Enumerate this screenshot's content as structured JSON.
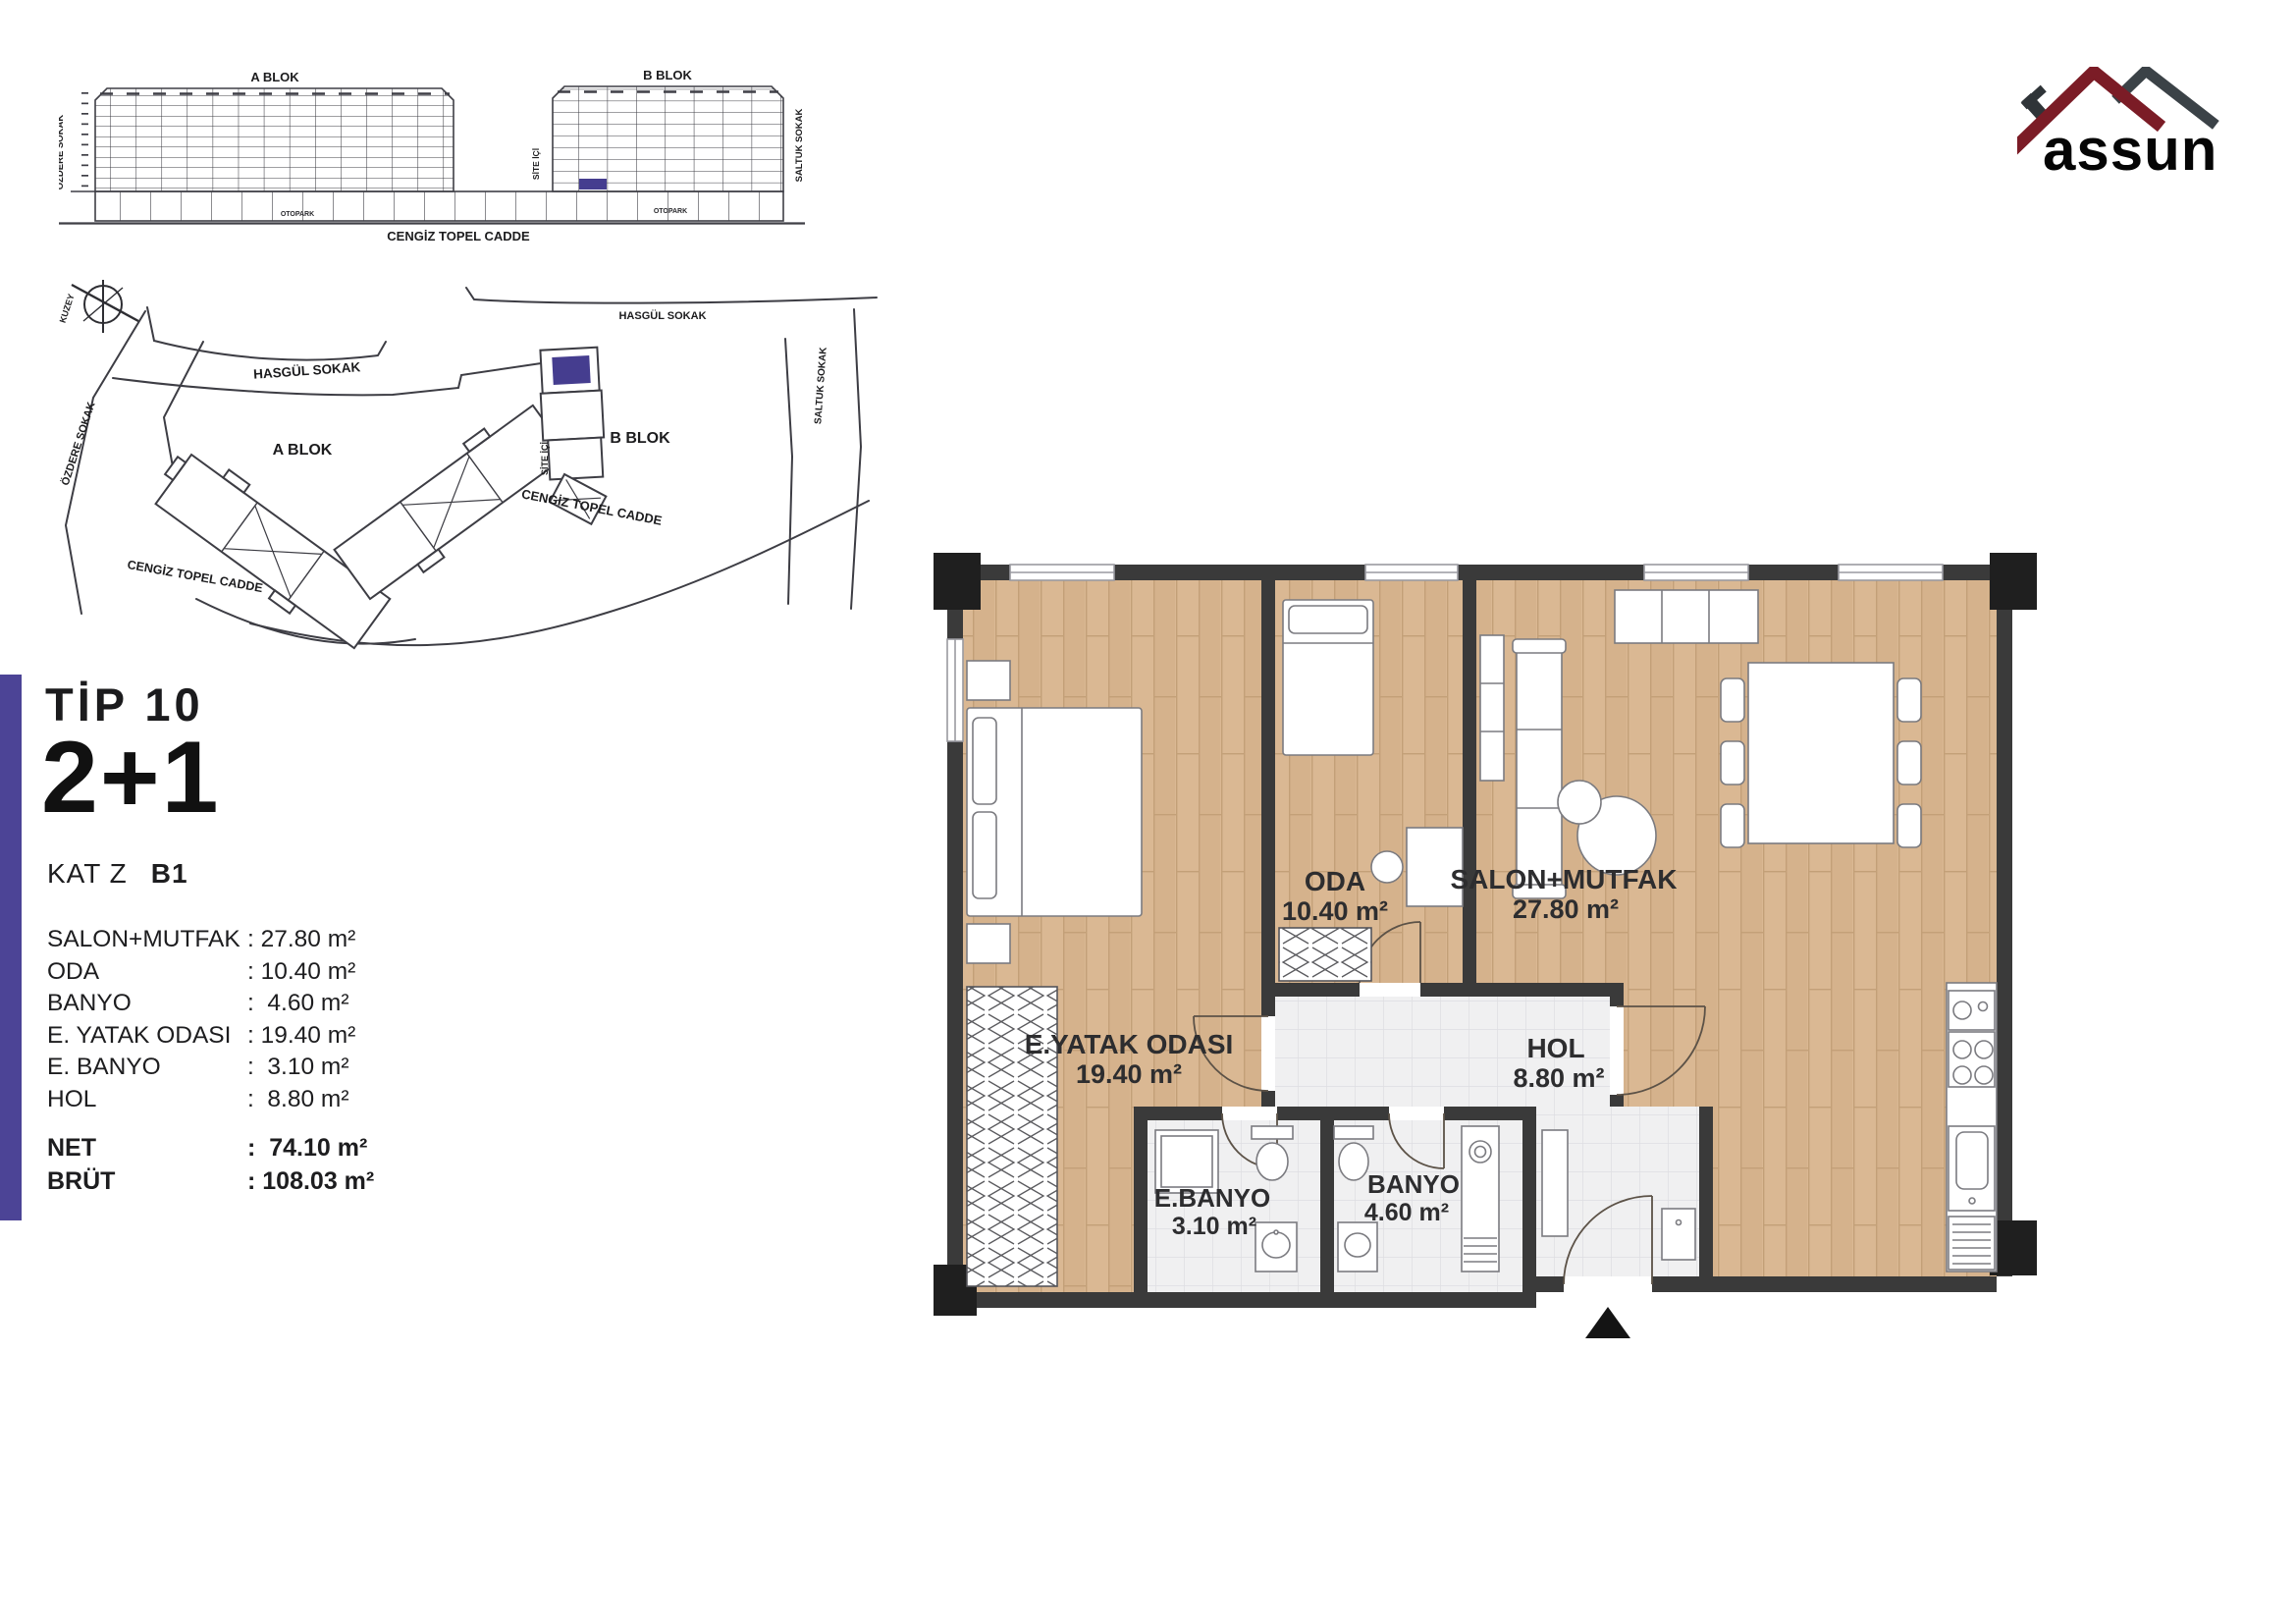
{
  "brand": {
    "name": "assun",
    "roof_primary_color": "#7b1c26",
    "roof_secondary_color": "#3b4247"
  },
  "elevation": {
    "a_blok_label": "A BLOK",
    "b_blok_label": "B BLOK",
    "street_left": "ÖZDERE SOKAK",
    "street_mid": "SİTE İÇİ",
    "street_right": "SALTUK SOKAK",
    "street_bottom": "CENGİZ TOPEL CADDE",
    "otopark_a": "OTOPARK",
    "otopark_b": "OTOPARK"
  },
  "site_map": {
    "north_label": "KUZEY",
    "hasgul_1": "HASGÜL SOKAK",
    "hasgul_2": "HASGÜL SOKAK",
    "ozdere": "ÖZDERE SOKAK",
    "site_ici": "SİTE İÇİ",
    "saltuk": "SALTUK SOKAK",
    "cengiz_1": "CENGİZ TOPEL CADDE",
    "cengiz_2": "CENGİZ TOPEL CADDE",
    "a_blok_label": "A BLOK",
    "b_blok_label": "B BLOK",
    "highlight_color": "#453d8f"
  },
  "unit_info": {
    "type_label": "TİP 10",
    "layout_label": "2+1",
    "floor_label": "KAT Z",
    "unit_label": "B1",
    "rooms": [
      {
        "label": "SALON+MUTFAK",
        "value": ": 27.80 m²"
      },
      {
        "label": "ODA",
        "value": ": 10.40 m²"
      },
      {
        "label": "BANYO",
        "value": ":  4.60 m²"
      },
      {
        "label": "E. YATAK ODASI",
        "value": ": 19.40 m²"
      },
      {
        "label": "E. BANYO",
        "value": ":  3.10 m²"
      },
      {
        "label": "HOL",
        "value": ":  8.80 m²"
      }
    ],
    "totals": [
      {
        "label": "NET",
        "value": ":  74.10 m²"
      },
      {
        "label": "BRÜT",
        "value": ": 108.03 m²"
      }
    ]
  },
  "floor_plan": {
    "wall_color": "#3a3a3a",
    "wood_color": "#dab893",
    "tile_color": "#f0f0f1",
    "rooms": [
      {
        "name": "ODA",
        "area": "10.40 m²"
      },
      {
        "name": "SALON+MUTFAK",
        "area": "27.80 m²"
      },
      {
        "name": "E.YATAK ODASI",
        "area": "19.40 m²"
      },
      {
        "name": "HOL",
        "area": "8.80 m²"
      },
      {
        "name": "E.BANYO",
        "area": "3.10 m²"
      },
      {
        "name": "BANYO",
        "area": "4.60 m²"
      }
    ]
  }
}
